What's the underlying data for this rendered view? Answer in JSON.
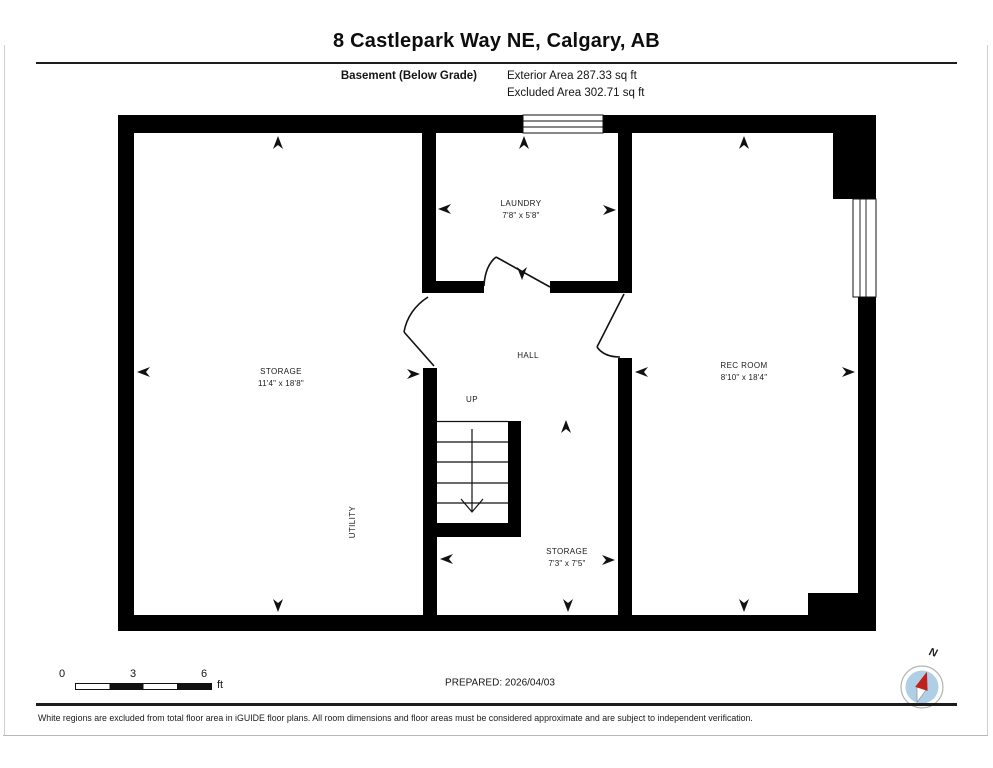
{
  "header": {
    "title": "8 Castlepark Way NE, Calgary, AB",
    "floor_label": "Basement (Below Grade)",
    "area_line1": "Exterior Area 287.33 sq ft",
    "area_line2": "Excluded Area 302.71 sq ft"
  },
  "rooms": {
    "storage_left": {
      "name": "STORAGE",
      "dims": "11'4\" x 18'8\""
    },
    "utility": {
      "name": "UTILITY"
    },
    "laundry": {
      "name": "LAUNDRY",
      "dims": "7'8\" x 5'8\""
    },
    "hall": {
      "name": "HALL"
    },
    "stairs": {
      "name": "UP"
    },
    "storage_bottom": {
      "name": "STORAGE",
      "dims": "7'3\" x 7'5\""
    },
    "rec_room": {
      "name": "REC ROOM",
      "dims": "8'10\" x 18'4\""
    }
  },
  "scale_bar": {
    "ticks": [
      "0",
      "3",
      "6"
    ],
    "unit": "ft"
  },
  "compass": {
    "label": "N"
  },
  "footer": {
    "prepared": "PREPARED: 2026/04/03",
    "disclaimer": "White regions are excluded from total floor area in iGUIDE floor plans. All room dimensions and floor areas must be considered approximate and are subject to independent verification."
  },
  "colors": {
    "wall": "#000000",
    "compass_blue": "#aecfe6",
    "compass_red": "#c2201a"
  }
}
